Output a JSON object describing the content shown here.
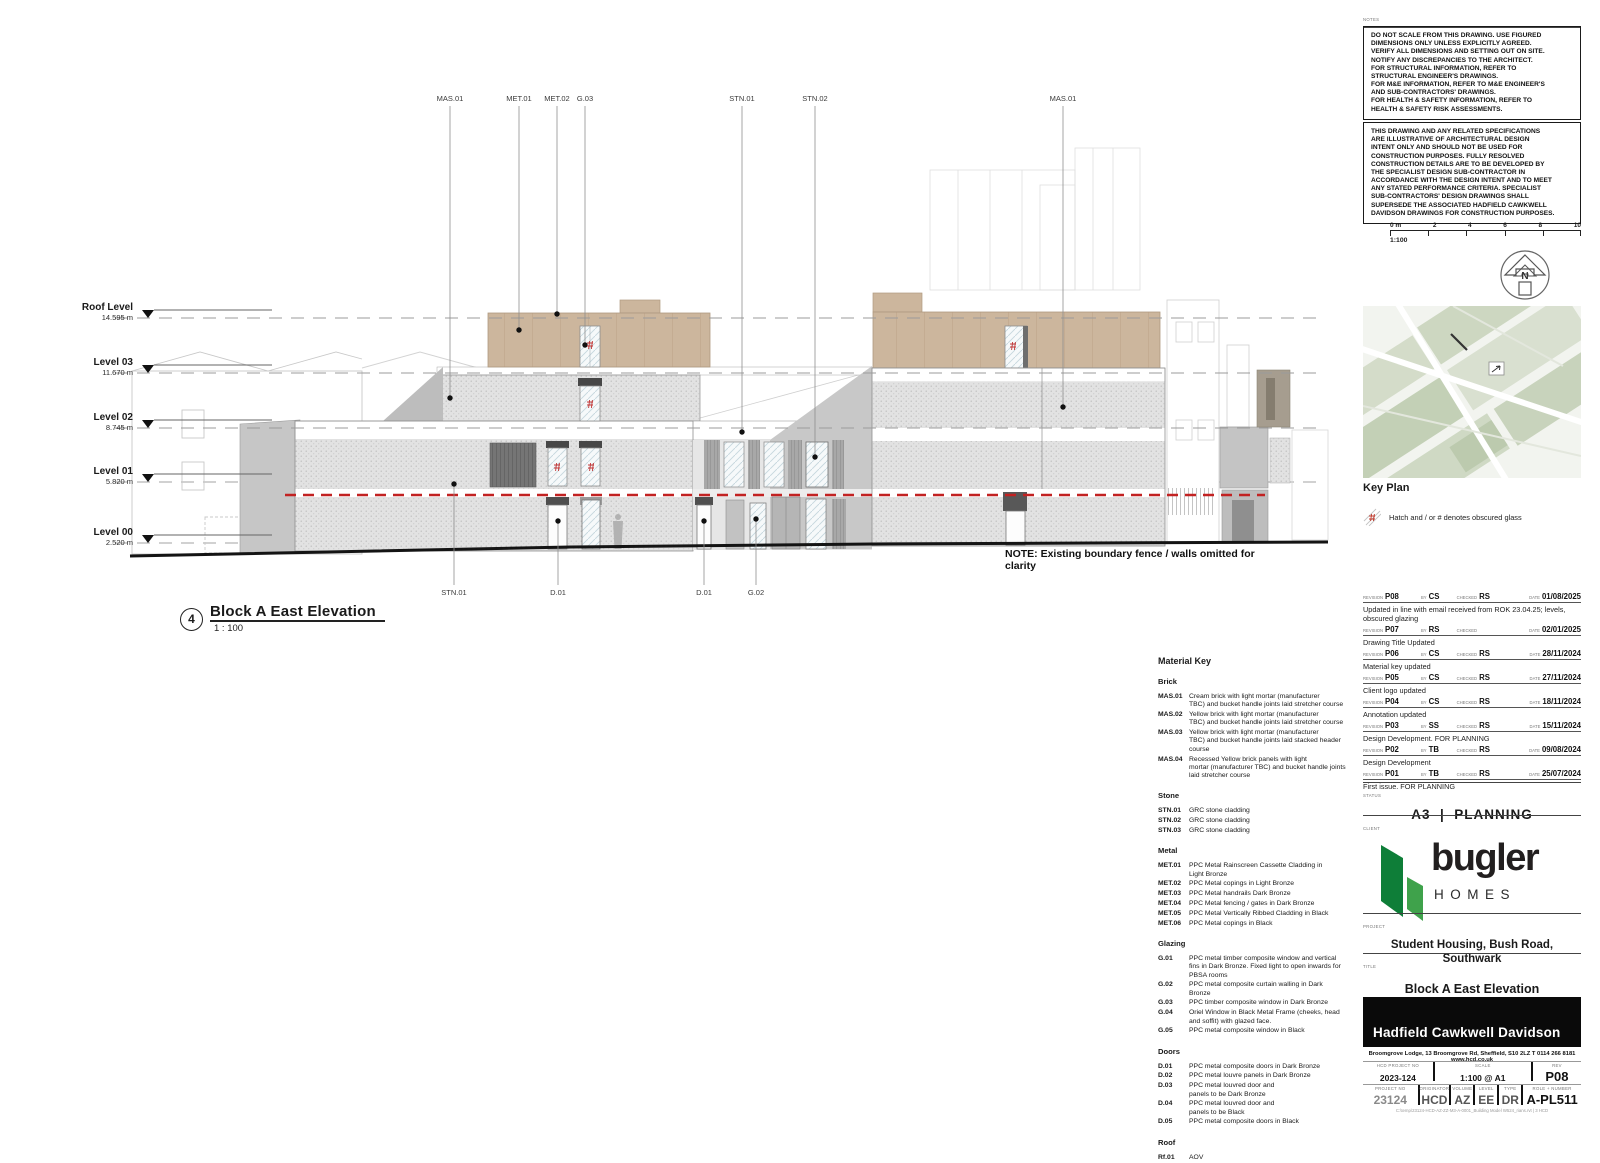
{
  "notes": {
    "label": "NOTES",
    "box1": "DO NOT SCALE FROM THIS DRAWING. USE FIGURED\nDIMENSIONS ONLY UNLESS EXPLICITLY AGREED.\nVERIFY ALL DIMENSIONS AND SETTING OUT ON SITE.\nNOTIFY ANY DISCREPANCIES TO THE ARCHITECT.\nFOR STRUCTURAL INFORMATION, REFER TO\nSTRUCTURAL ENGINEER'S DRAWINGS.\nFOR M&E INFORMATION, REFER TO M&E ENGINEER'S\nAND SUB-CONTRACTORS' DRAWINGS.\nFOR HEALTH & SAFETY INFORMATION, REFER TO\nHEALTH & SAFETY RISK ASSESSMENTS.",
    "box2": "THIS DRAWING AND ANY RELATED SPECIFICATIONS\nARE ILLUSTRATIVE OF ARCHITECTURAL DESIGN\nINTENT ONLY AND SHOULD NOT BE USED FOR\nCONSTRUCTION PURPOSES.  FULLY RESOLVED\nCONSTRUCTION DETAILS ARE TO BE DEVELOPED BY\nTHE SPECIALIST DESIGN SUB-CONTRACTOR IN\nACCORDANCE WITH THE DESIGN INTENT AND TO MEET\nANY STATED PERFORMANCE CRITERIA.  SPECIALIST\nSUB-CONTRACTORS' DESIGN DRAWINGS SHALL\nSUPERSEDE THE ASSOCIATED HADFIELD CAWKWELL\nDAVIDSON DRAWINGS FOR CONSTRUCTION PURPOSES."
  },
  "scale_bar": {
    "ticks": [
      "0 m",
      "2",
      "4",
      "6",
      "8",
      "10"
    ],
    "ratio": "1:100"
  },
  "north": {
    "letter": "N"
  },
  "key_plan": {
    "title": "Key Plan",
    "legend": "Hatch and / or # denotes obscured glass"
  },
  "drawing": {
    "levels": [
      {
        "name": "Roof Level",
        "height": "14.595 m"
      },
      {
        "name": "Level 03",
        "height": "11.670 m"
      },
      {
        "name": "Level 02",
        "height": "8.745 m"
      },
      {
        "name": "Level 01",
        "height": "5.820 m"
      },
      {
        "name": "Level 00",
        "height": "2.520 m"
      }
    ],
    "top_labels": [
      "MAS.01",
      "MET.01",
      "MET.02",
      "G.03",
      "STN.01",
      "STN.02",
      "MAS.01"
    ],
    "bottom_labels": [
      "STN.01",
      "D.01",
      "D.01",
      "G.02"
    ],
    "note": "NOTE: Existing boundary fence / walls omitted for clarity",
    "viewport": {
      "number": "4",
      "title": "Block A East Elevation",
      "scale": "1 : 100"
    }
  },
  "material_key": {
    "title": "Material Key",
    "brick_heading": "Brick",
    "brick": [
      {
        "code": "MAS.01",
        "desc": "Cream brick with light mortar (manufacturer\nTBC) and bucket handle joints laid stretcher course"
      },
      {
        "code": "MAS.02",
        "desc": "Yellow brick with light mortar (manufacturer\nTBC) and bucket handle joints laid stretcher course"
      },
      {
        "code": "MAS.03",
        "desc": "Yellow brick with light mortar (manufacturer\nTBC) and bucket handle joints laid stacked header\ncourse"
      },
      {
        "code": "MAS.04",
        "desc": "Recessed Yellow brick panels with light\nmortar (manufacturer TBC) and bucket handle joints\nlaid stretcher course"
      }
    ],
    "stone_heading": "Stone",
    "stone": [
      {
        "code": "STN.01",
        "desc": "GRC stone cladding"
      },
      {
        "code": "STN.02",
        "desc": "GRC stone cladding"
      },
      {
        "code": "STN.03",
        "desc": "GRC stone cladding"
      }
    ],
    "metal_heading": "Metal",
    "metal": [
      {
        "code": "MET.01",
        "desc": "PPC Metal Rainscreen Cassette Cladding in\nLight Bronze"
      },
      {
        "code": "MET.02",
        "desc": "PPC Metal copings in Light Bronze"
      },
      {
        "code": "MET.03",
        "desc": "PPC Metal handrails Dark Bronze"
      },
      {
        "code": "MET.04",
        "desc": "PPC Metal fencing / gates in Dark Bronze"
      },
      {
        "code": "MET.05",
        "desc": "PPC Metal Vertically Ribbed Cladding in Black"
      },
      {
        "code": "MET.06",
        "desc": "PPC Metal copings in Black"
      }
    ],
    "glazing_heading": "Glazing",
    "glazing": [
      {
        "code": "G.01",
        "desc": "PPC metal timber composite window and vertical\nfins in Dark Bronze. Fixed light to open inwards for\nPBSA rooms"
      },
      {
        "code": "G.02",
        "desc": "PPC metal composite curtain walling in Dark\nBronze"
      },
      {
        "code": "G.03",
        "desc": "PPC timber composite window in Dark Bronze"
      },
      {
        "code": "G.04",
        "desc": "Oriel Window in Black Metal Frame (cheeks, head\nand soffit) with glazed face."
      },
      {
        "code": "G.05",
        "desc": "PPC metal composite window in Black"
      }
    ],
    "doors_heading": "Doors",
    "doors": [
      {
        "code": "D.01",
        "desc": "PPC metal composite doors in Dark Bronze"
      },
      {
        "code": "D.02",
        "desc": "PPC metal louvre panels in Dark Bronze"
      },
      {
        "code": "D.03",
        "desc": "PPC metal louvred door and\npanels to be Dark Bronze"
      },
      {
        "code": "D.04",
        "desc": "PPC metal louvred door and\npanels to be Black"
      },
      {
        "code": "D.05",
        "desc": "PPC metal composite doors in Black"
      }
    ],
    "roof_heading": "Roof",
    "roof": [
      {
        "code": "Rf.01",
        "desc": "AOV"
      }
    ]
  },
  "revisions": {
    "labels": {
      "rev": "REVISION",
      "by": "BY",
      "checked": "CHECKED",
      "date": "DATE"
    },
    "rows": [
      {
        "rev": "P08",
        "by": "CS",
        "checked": "RS",
        "date": "01/08/2025",
        "desc": "Updated in line with email received from ROK 23.04.25; levels,\nobscured glazing"
      },
      {
        "rev": "P07",
        "by": "RS",
        "checked": "",
        "date": "02/01/2025",
        "desc": "Drawing Title Updated"
      },
      {
        "rev": "P06",
        "by": "CS",
        "checked": "RS",
        "date": "28/11/2024",
        "desc": "Material key updated"
      },
      {
        "rev": "P05",
        "by": "CS",
        "checked": "RS",
        "date": "27/11/2024",
        "desc": "Client logo updated"
      },
      {
        "rev": "P04",
        "by": "CS",
        "checked": "RS",
        "date": "18/11/2024",
        "desc": "Annotation updated"
      },
      {
        "rev": "P03",
        "by": "SS",
        "checked": "RS",
        "date": "15/11/2024",
        "desc": "Design Development. FOR PLANNING"
      },
      {
        "rev": "P02",
        "by": "TB",
        "checked": "RS",
        "date": "09/08/2024",
        "desc": "Design Development"
      },
      {
        "rev": "P01",
        "by": "TB",
        "checked": "RS",
        "date": "25/07/2024",
        "desc": "First issue. FOR PLANNING"
      }
    ]
  },
  "status": {
    "label": "STATUS",
    "value": "A3  |  PLANNING"
  },
  "client": {
    "label": "CLIENT",
    "brand": "bugler",
    "brand_sub": "HOMES"
  },
  "project": {
    "label": "PROJECT",
    "name": "Student Housing, Bush Road,\nSouthwark"
  },
  "sheet_title": {
    "label": "TITLE",
    "name": "Block A East Elevation\nAs Proposed"
  },
  "architect": {
    "name": "Hadfield Cawkwell Davidson",
    "address": "Broomgrove Lodge, 13 Broomgrove Rd, Sheffield, S10 2LZ    T 0114 266 8181    www.hcd.co.uk"
  },
  "title_block": {
    "fields_row1": [
      {
        "label": "HCD PROJECT NO",
        "value": "2023-124"
      },
      {
        "label": "SCALE",
        "value": "1:100 @ A1"
      },
      {
        "label": "REV",
        "value": "P08"
      }
    ],
    "fields_row2": [
      {
        "label": "PROJECT NO",
        "value": "23124"
      },
      {
        "label": "ORIGINATOR",
        "value": "HCD"
      },
      {
        "label": "VOLUME",
        "value": "AZ"
      },
      {
        "label": "LEVEL",
        "value": "EE"
      },
      {
        "label": "TYPE",
        "value": "DR"
      },
      {
        "label": "ROLE + NUMBER",
        "value": "A-PL511"
      }
    ],
    "footer": "C:\\temp\\23124-HCD-AZ-ZZ-M3-A-0001_Building Model W524_rians.rvt   |   3 HCD"
  },
  "colors": {
    "tan_brick": "#ccb69d",
    "red_dashed_line": "#c22222",
    "logo_green_dark": "#0e7e38",
    "logo_green_light": "#3fa24b"
  }
}
